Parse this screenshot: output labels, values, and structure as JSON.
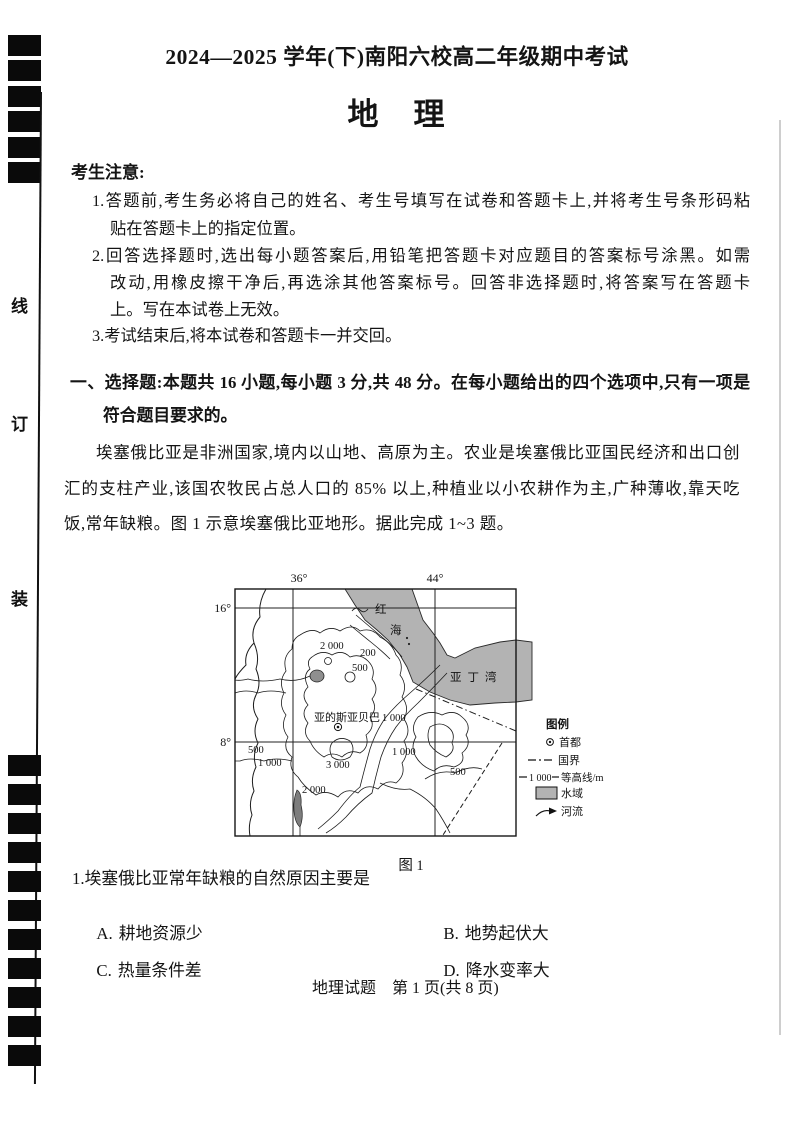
{
  "header": {
    "exam_session": "2024—2025 学年(下)南阳六校高二年级期中考试",
    "subject": "地　理"
  },
  "binding": {
    "chars": [
      "线",
      "订",
      "装"
    ]
  },
  "notice": {
    "heading": "考生注意:",
    "lines": [
      "1.答题前,考生务必将自己的姓名、考生号填写在试卷和答题卡上,并将考生号条形码粘",
      "贴在答题卡上的指定位置。",
      "2.回答选择题时,选出每小题答案后,用铅笔把答题卡对应题目的答案标号涂黑。如需",
      "改动,用橡皮擦干净后,再选涂其他答案标号。回答非选择题时,将答案写在答题卡",
      "上。写在本试卷上无效。",
      "3.考试结束后,将本试卷和答题卡一并交回。"
    ]
  },
  "section1": {
    "heading_line1": "一、选择题:本题共 16 小题,每小题 3 分,共 48 分。在每小题给出的四个选项中,只有一项是",
    "heading_line2": "符合题目要求的。"
  },
  "passage1": {
    "lines": [
      "埃塞俄比亚是非洲国家,境内以山地、高原为主。农业是埃塞俄比亚国民经济和出口创",
      "汇的支柱产业,该国农牧民占总人口的 85% 以上,种植业以小农耕作为主,广种薄收,靠天吃",
      "饭,常年缺粮。图 1 示意埃塞俄比亚地形。据此完成 1~3 题。"
    ]
  },
  "map": {
    "lon_labels": [
      "36°",
      "44°"
    ],
    "lat_labels": [
      "16°",
      "8°"
    ],
    "red_sea_chars": [
      "红",
      "海"
    ],
    "gulf_label": "亚丁湾",
    "capital_label": "亚的斯亚贝巴",
    "contour_labels": {
      "addis": "1 000",
      "ne_2000": "2 000",
      "ne_200": "200",
      "ne_500": "500",
      "w_500": "500",
      "w_1000": "1 000",
      "c_3000": "3 000",
      "se_1000": "1 000",
      "se_500": "500",
      "s_2000": "2 000"
    },
    "caption": "图 1",
    "legend": {
      "title": "图例",
      "capital": "首都",
      "border": "国界",
      "contour_value": "1 000",
      "contour_label": "等高线/m",
      "water": "水域",
      "river": "河流"
    },
    "water_color": "#b3b3b3"
  },
  "question1": {
    "stem": "1.埃塞俄比亚常年缺粮的自然原因主要是",
    "options": [
      {
        "key": "A.",
        "label": "耕地资源少"
      },
      {
        "key": "B.",
        "label": "地势起伏大"
      },
      {
        "key": "C.",
        "label": "热量条件差"
      },
      {
        "key": "D.",
        "label": "降水变率大"
      }
    ]
  },
  "footer": {
    "text": "地理试题　第 1 页(共 8 页)"
  }
}
